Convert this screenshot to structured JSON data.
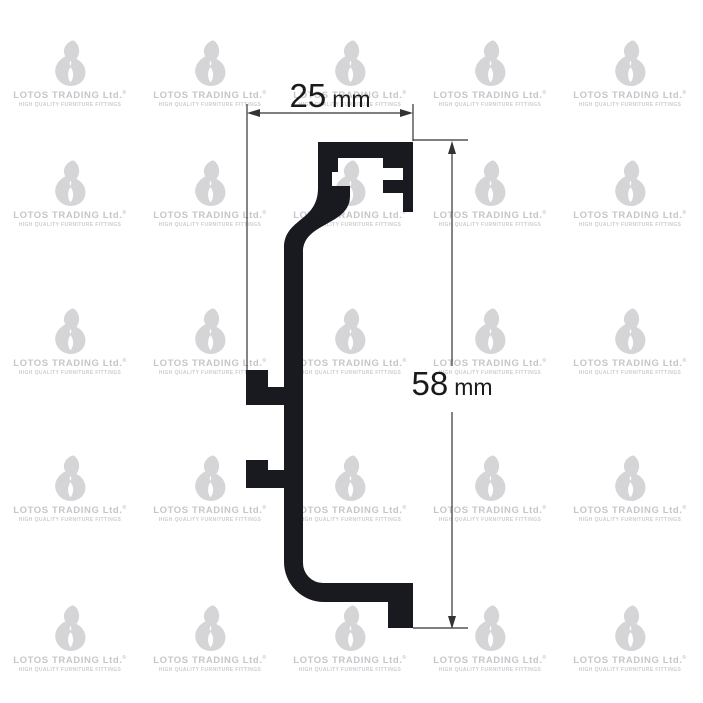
{
  "page": {
    "background": "#ffffff"
  },
  "watermark": {
    "brand": "LOTOS TRADING Ltd.",
    "registered_mark": "®",
    "tagline": "HIGH QUALITY FURNITURE FITTINGS",
    "flame_color": "#d5d5d8",
    "text_color": "#c6c6cb",
    "grid": {
      "columns_x": [
        70,
        210,
        350,
        490,
        630
      ],
      "rows_y": [
        40,
        160,
        308,
        455,
        605
      ]
    }
  },
  "drawing": {
    "subject": "aluminium gola profile cross-section",
    "profile_color": "#191920",
    "line_color": "#333333",
    "dimensions": {
      "width": {
        "value": "25",
        "unit": "mm"
      },
      "height": {
        "value": "58",
        "unit": "mm"
      }
    }
  }
}
